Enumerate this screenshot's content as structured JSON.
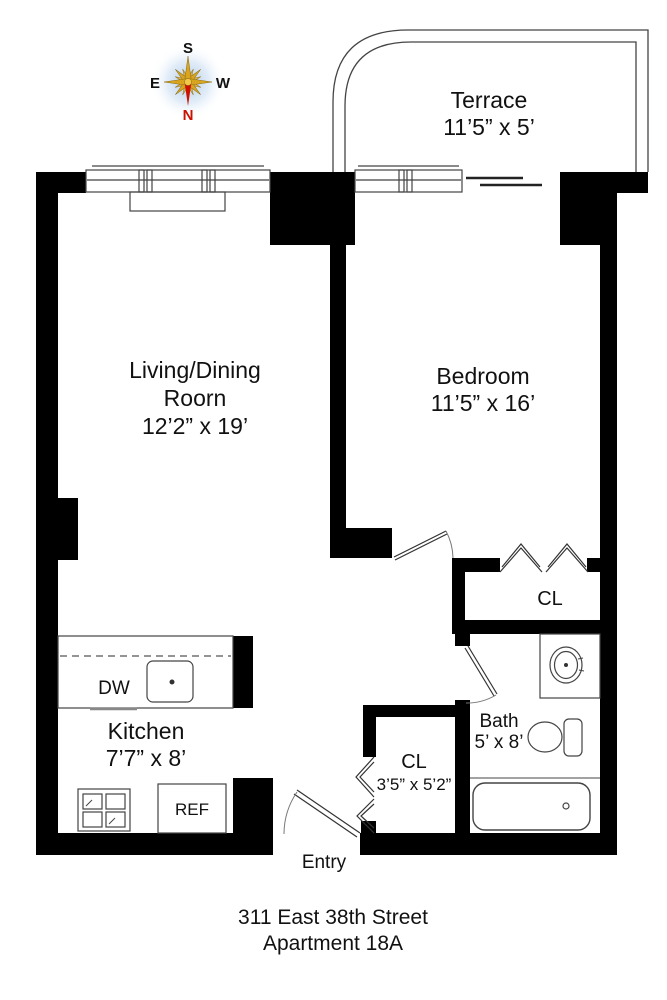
{
  "title": {
    "line1": "311 East 38th Street",
    "line2": "Apartment 18A"
  },
  "compass": {
    "north": "N",
    "south": "S",
    "east": "E",
    "west": "W"
  },
  "rooms": {
    "terrace": {
      "name": "Terrace",
      "dims": "11’5” x 5’"
    },
    "living": {
      "name_line1": "Living/Dining",
      "name_line2": "Roorn",
      "dims": "12’2” x 19’"
    },
    "bedroom": {
      "name": "Bedroom",
      "dims": "11’5” x 16’"
    },
    "kitchen": {
      "name": "Kitchen",
      "dims": "7’7” x 8’"
    },
    "bath": {
      "name": "Bath",
      "dims": "5’ x 8’"
    },
    "bedroom_closet": {
      "name": "CL"
    },
    "entry_closet": {
      "name": "CL",
      "dims": "3’5” x 5’2”"
    },
    "entry": {
      "name": "Entry"
    }
  },
  "appliances": {
    "dishwasher": "DW",
    "refrigerator": "REF"
  },
  "colors": {
    "wall": "#000000",
    "line": "#444444",
    "text": "#111111",
    "north": "#cc1100",
    "compass_gold": "#d9a520",
    "compass_glow": "#b9d0ea"
  }
}
